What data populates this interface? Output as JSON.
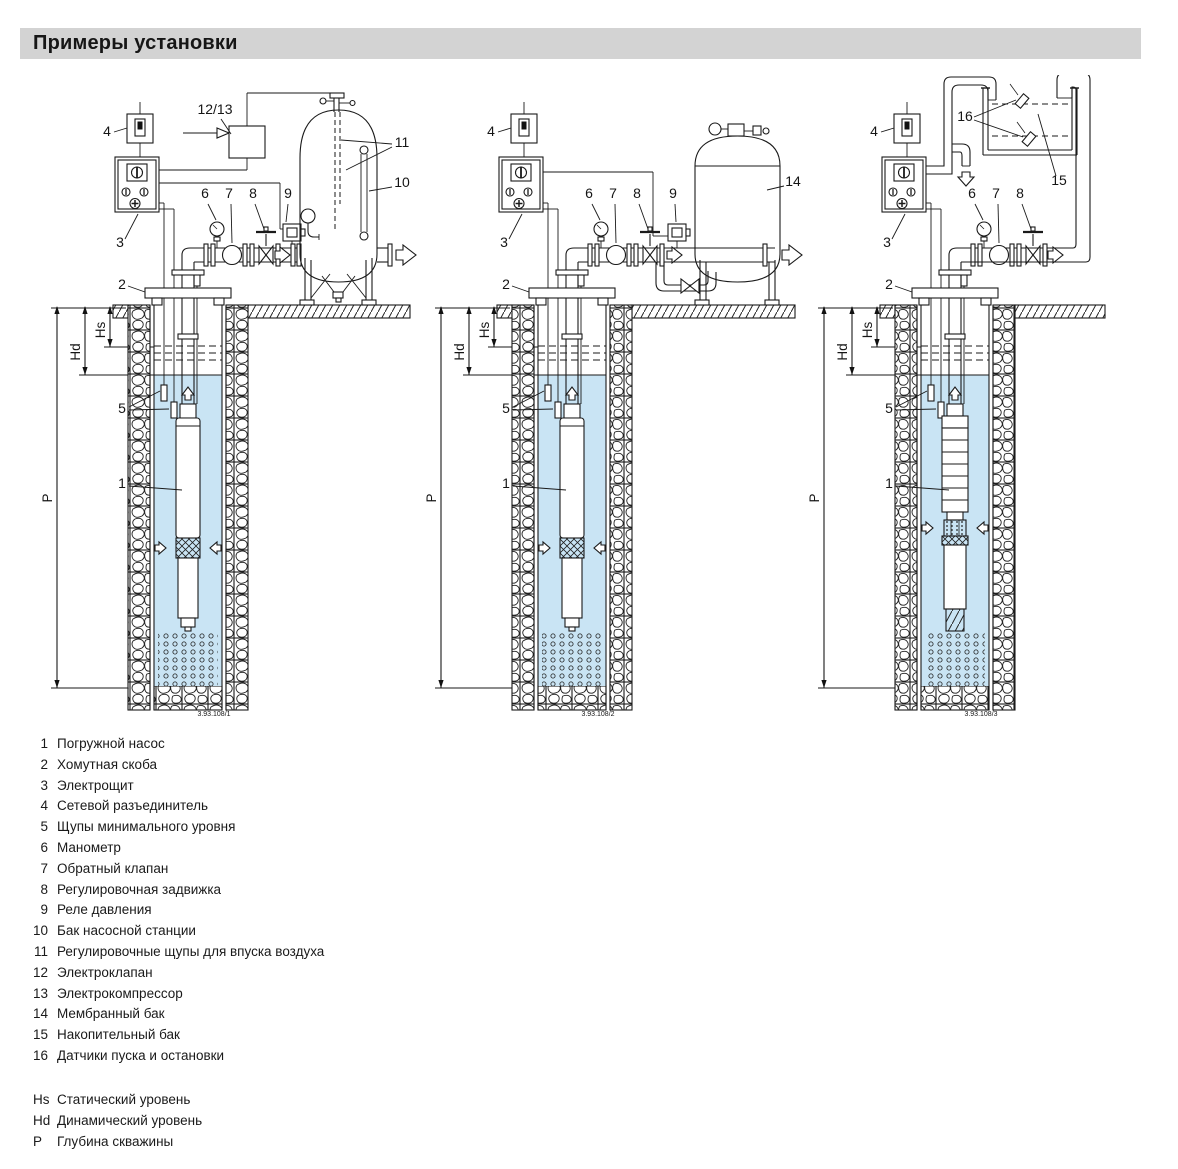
{
  "header": {
    "title": "Примеры установки"
  },
  "diagrams": [
    {
      "caption": "3.93.108/1",
      "callouts": {
        "n1": "1",
        "n2": "2",
        "n3": "3",
        "n4": "4",
        "n5": "5",
        "n6": "6",
        "n7": "7",
        "n8": "8",
        "n9": "9",
        "n10": "10",
        "n11": "11",
        "n12_13": "12/13"
      },
      "dims": {
        "hs": "Hs",
        "hd": "Hd",
        "p": "P"
      }
    },
    {
      "caption": "3.93.108/2",
      "callouts": {
        "n1": "1",
        "n2": "2",
        "n3": "3",
        "n4": "4",
        "n5": "5",
        "n6": "6",
        "n7": "7",
        "n8": "8",
        "n9": "9",
        "n14": "14"
      },
      "dims": {
        "hs": "Hs",
        "hd": "Hd",
        "p": "P"
      }
    },
    {
      "caption": "3.93.108/3",
      "callouts": {
        "n1": "1",
        "n2": "2",
        "n3": "3",
        "n4": "4",
        "n5": "5",
        "n6": "6",
        "n7": "7",
        "n8": "8",
        "n15": "15",
        "n16": "16"
      },
      "dims": {
        "hs": "Hs",
        "hd": "Hd",
        "p": "P"
      }
    }
  ],
  "legend": {
    "items": [
      {
        "num": "1",
        "label": "Погружной насос"
      },
      {
        "num": "2",
        "label": "Хомутная скоба"
      },
      {
        "num": "3",
        "label": "Электрощит"
      },
      {
        "num": "4",
        "label": "Сетевой разъединитель"
      },
      {
        "num": "5",
        "label": "Щупы минимального уровня"
      },
      {
        "num": "6",
        "label": "Манометр"
      },
      {
        "num": "7",
        "label": "Обратный клапан"
      },
      {
        "num": "8",
        "label": "Регулировочная задвижка"
      },
      {
        "num": "9",
        "label": "Реле давления"
      },
      {
        "num": "10",
        "label": "Бак насосной станции"
      },
      {
        "num": "11",
        "label": "Регулировочные щупы для впуска воздуха"
      },
      {
        "num": "12",
        "label": "Электроклапан"
      },
      {
        "num": "13",
        "label": "Электрокомпрессор"
      },
      {
        "num": "14",
        "label": "Мембранный бак"
      },
      {
        "num": "15",
        "label": "Накопительный бак"
      },
      {
        "num": "16",
        "label": "Датчики пуска и остановки"
      }
    ]
  },
  "abbreviations": [
    {
      "key": "Hs",
      "label": "Статический уровень"
    },
    {
      "key": "Hd",
      "label": "Динамический уровень"
    },
    {
      "key": "P",
      "label": "Глубина скважины"
    }
  ],
  "colors": {
    "water": "#c9e4f4",
    "titlebar": "#d3d3d3",
    "line": "#1a1a1a"
  }
}
